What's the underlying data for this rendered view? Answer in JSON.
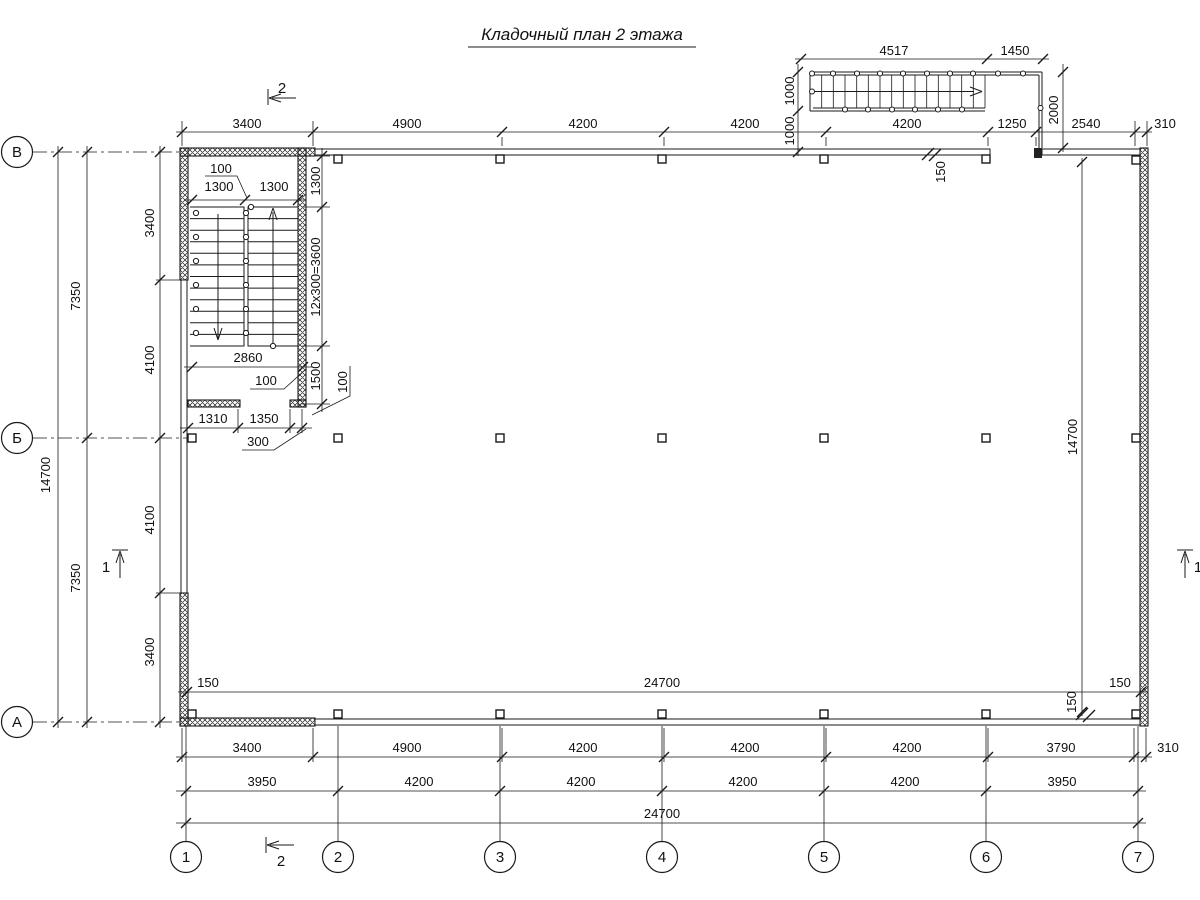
{
  "title": "Кладочный план 2 этажа",
  "grid": {
    "cols": [
      "1",
      "2",
      "3",
      "4",
      "5",
      "6",
      "7"
    ],
    "rows": [
      "В",
      "Б",
      "А"
    ]
  },
  "sections": {
    "one": "1",
    "two": "2"
  },
  "dims": {
    "top": [
      "3400",
      "4900",
      "4200",
      "4200",
      "4200",
      "1250",
      "2540",
      "310"
    ],
    "ext_top": [
      "4517",
      "1450"
    ],
    "ext_left": [
      "1000",
      "1000"
    ],
    "ext_right": "2000",
    "wall150_top": "150",
    "wall150_bottom": "150",
    "left_inner": [
      "3400",
      "4100",
      "4100",
      "3400"
    ],
    "left_mid": [
      "7350",
      "7350"
    ],
    "left_outer": "14700",
    "right_inner": "14700",
    "inner_width": [
      "150",
      "24700",
      "150"
    ],
    "bottom_r1": [
      "3400",
      "4900",
      "4200",
      "4200",
      "4200",
      "3790",
      "310"
    ],
    "bottom_r2": [
      "3950",
      "4200",
      "4200",
      "4200",
      "4200",
      "3950"
    ],
    "bottom_r3": "24700",
    "stair": {
      "gap100": "100",
      "fl_left": "1300",
      "fl_right": "1300",
      "v1300": "1300",
      "run": "12x300=3600",
      "v1500": "1500",
      "v100": "100",
      "run2860": "2860",
      "wall100": "100",
      "d1310": "1310",
      "d1350": "1350",
      "d300": "300"
    }
  }
}
